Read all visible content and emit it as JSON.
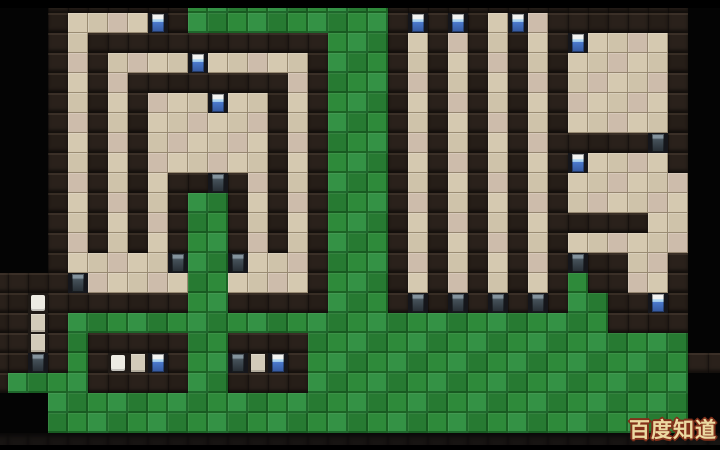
{
  "scene": {
    "description": "Top-down tile-based prison/base building game map (video frame). Left: spiral maze of dark walls and tan floors with blue doors; a green grass stem runs from the maze center to the grass field below. Middle: four narrow vertical floor corridors with blue doors at top and dark doors at bottom. Right: rectangular rooms and a small maze with blue and dark doors. Bottom: large green grass field containing two small walled bed cells and one vertical bed cell at the left edge.",
    "width": 720,
    "height": 450
  },
  "tilemap": {
    "tile_size": 20,
    "offset_x": -12,
    "offset_y": -7,
    "cols": 37,
    "rows": 23,
    "legend": {
      "K": "void",
      "W": "wall",
      "F": "floor",
      "G": "grass",
      "D": "blue-door",
      "d": "dark-door",
      "P": "bed-pillow",
      "B": "bed-body",
      "b": "bottom-band"
    },
    "grid": [
      "KKKWWWWWWWGGGGGGGGGGWWWWWWWWWWWWWWWKK",
      "KKKWFFFFDWGGGGGGGGGGWDWDWFDFWWWWWWWKK",
      "KKKWFWWWWWWWWWWWWGGGWFWFWFWFWDFFFFWKK",
      "KKKWFWFFFFDFFFFFWGGGWFWFWFWFWFFFFFWKK",
      "KKKWFWFWWWWWWWWFWGGGWFWFWFWFWFFFFFWKK",
      "KKKWFWFWFFFDFFWFWGGGWFWFWFWFWFFFFFWKK",
      "KKKWFWFWFFFFFFWFWGGGWFWFWFWFWFFFFFWKK",
      "KKKWFWFWFFFFFFWFWGGGWFWFWFWFWWWWWdWKK",
      "KKKWFWFWFFFFFFWFWGGGWFWFWFWFWDFFFFWKK",
      "KKKWFWFWFWWdWFWFWGGGWFWFWFWFWFFFFFFKK",
      "KKKWFWFWFWGGWFWFWGGGWFWFWFWFWFFFFFFKK",
      "KKKWFWFWFWGGWFWFWGGGWFWFWFWFWWWWWFFKK",
      "KKKWFWFWFWGGWFWFWGGGWFWFWFWFWFFFFFFKK",
      "KKKWFFFFFdGGdFFFWGGGWFWFWFWFWdWWFFWKK",
      "WWWWdFFFFFGGFFFFWGGGWFWFWFWFWGWWFFWKK",
      "WWPWWWWWWWGGWWWWWGGGWdWdWdWdWGGWWDWKK",
      "WWBWGGGGGGGGGGGGGGGGGGGGGGGGGGGWWWWKK",
      "WWBWGWWWWWGGWWWWGGGGGGGGGGGGGGGGGGGKK",
      "WWdWGWPBDWGGdBDWGGGGGGGGGGGGGGGGGGGWW",
      "WGGGGWWWWWGGWWWWGGGGGGGGGGGGGGGGGGGKK",
      "KKKGGGGGGGGGGGGGGGGGGGGGGGGGGGGGGGGKK",
      "KKKGGGGGGGGGGGGGGGGGGGGGGGGGGGGGGGGKK",
      "bbbbbbbbbbbbbbbbbbbbbbbbbbbbbbbbbbbbb"
    ],
    "objects": {
      "blue_doors": "spiral outer entry, spiral ring entries (2), corridor tops (3), right room entries (2), bed-cell doors (2), lower-right room door",
      "dark_doors": "maze center stem, spiral bottom corridor (2), spiral exit, corridor bottoms (4), right maze (2), left bed-cell door",
      "beds": "left edge vertical bed, two horizontal beds in grass-field cells"
    }
  },
  "palette": {
    "void": "#040404",
    "wall": "#2a211b",
    "wall2": "#261e18",
    "floor": "#cfc3aa",
    "floor_tint": "#cdbcab",
    "floor_lt": "#d5c9b0",
    "grass": "#2e8a3a",
    "grass_dark": "#277a32",
    "grass_light": "#349245",
    "band": "#171412",
    "frame": "#15161b",
    "door_top": "#f2f3f1",
    "door_blue_lt": "#aed6f2",
    "door_blue": "#4a79cc",
    "door_blue_dk": "#35589e",
    "door_dark_top": "#84939d",
    "door_dark_mid": "#46525b",
    "door_dark": "#262d33",
    "bedframe": "#1f1a16",
    "pillow": "#edebe3",
    "bed": "#d3cbb9",
    "wm_fill": "#ecd9a2",
    "wm_outline": "#82301a"
  },
  "watermark": {
    "text": "百度知道"
  }
}
